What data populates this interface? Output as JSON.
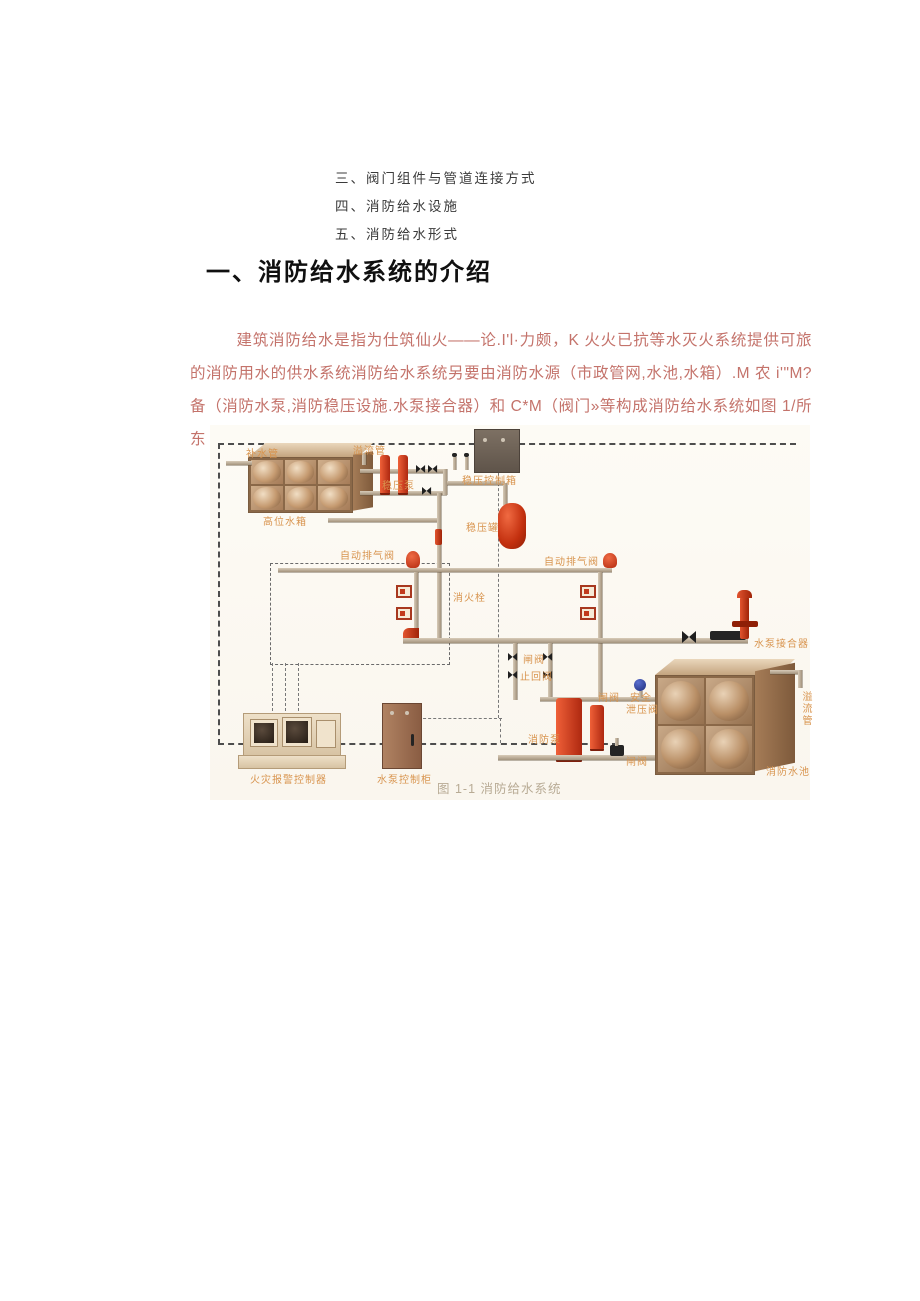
{
  "toc": {
    "items": [
      {
        "label": "三、阀门组件与管道连接方式"
      },
      {
        "label": "四、消防给水设施"
      },
      {
        "label": "五、消防给水形式"
      }
    ]
  },
  "content": {
    "heading": "一、消防给水系统的介绍",
    "paragraph": "建筑消防给水是指为仕筑仙火——论.I'l·力颇，K 火火已抗等水灭火系统提供可旅的消防用水的供水系统消防给水系统另要由消防水源（市政管网,水池,水箱）.M 农 i'\"M?备（消防水泵,消防稳压设施.水泵接合器）和 C*M（阀门»等构成消防给水系统如图 1/所东",
    "caption": "图 1-1 消防给水系统"
  },
  "diagram": {
    "labels": {
      "makeup_pipe": "补水管",
      "overflow_pipe": "溢流管",
      "stabilizer_pump": "稳压泵",
      "stabilizer_control_box": "稳压控制箱",
      "elevated_tank": "高位水箱",
      "pressure_tank": "稳压罐",
      "auto_air_valve": "自动排气阀",
      "hydrant": "消火栓",
      "pump_connector": "水泵接合器",
      "gate_valve": "闸阀",
      "check_valve": "止回阀",
      "safety_line1": "安全",
      "safety_line2": "泄压阀",
      "fire_pump": "消防泵",
      "fire_tank": "消防水池",
      "alarm_controller": "火灾报警控制器",
      "pump_cabinet": "水泵控制柜"
    },
    "colors": {
      "label_orange": "#d8944e",
      "paragraph_red": "#c4736b",
      "pipe_tan": "#b3a28e",
      "component_red": "#c63a20",
      "caption_gray": "#b8ab95"
    }
  }
}
